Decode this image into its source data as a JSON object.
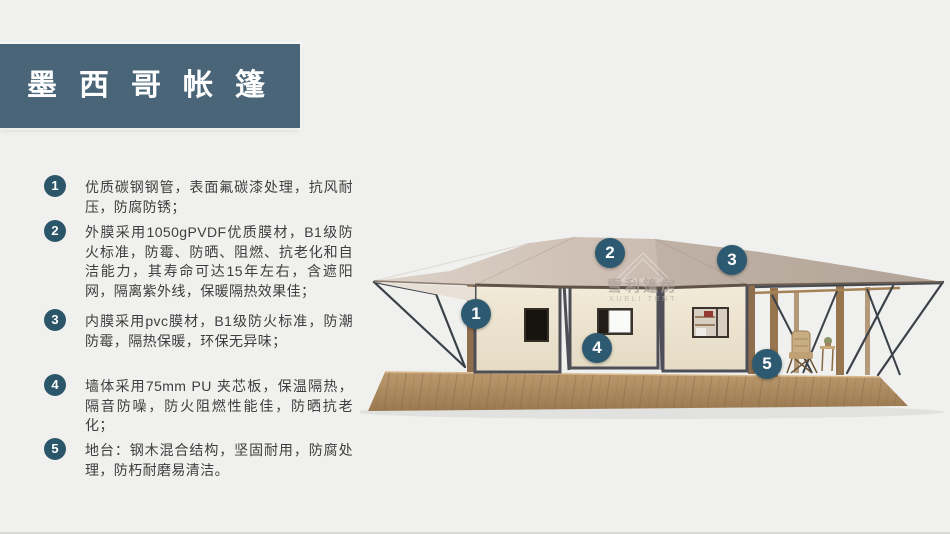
{
  "header": {
    "title": "墨西哥帐篷"
  },
  "features": [
    {
      "num": "1",
      "text": "优质碳钢钢管，表面氟碳漆处理，抗风耐压，防腐防锈；"
    },
    {
      "num": "2",
      "text": "外膜采用1050gPVDF优质膜材，B1级防火标准，防霉、防晒、阻燃、抗老化和自洁能力，其寿命可达15年左右，含遮阳网，隔离紫外线，保暖隔热效果佳；"
    },
    {
      "num": "3",
      "text": "内膜采用pvc膜材，B1级防火标准，防潮防霉，隔热保暖，环保无异味；"
    },
    {
      "num": "4",
      "text": "墙体采用75mm PU 夹芯板，保温隔热，隔音防噪，防火阻燃性能佳，防晒抗老化；"
    },
    {
      "num": "5",
      "text": "地台：钢木混合结构，坚固耐用，防腐处理，防朽耐磨易清洁。"
    }
  ],
  "illustration": {
    "watermark": {
      "cn": "雪利篷房",
      "en": "XUELI TENT"
    },
    "callouts": [
      {
        "num": "1"
      },
      {
        "num": "2"
      },
      {
        "num": "3"
      },
      {
        "num": "4"
      },
      {
        "num": "5"
      }
    ],
    "colors": {
      "title_bar": "#4a6577",
      "badge": "#2b5568",
      "callout": "#2d5a70",
      "roof": "#cbbcb1",
      "wall": "#ece4d2",
      "frame": "#4d4e56",
      "deck": "#ab875d",
      "text": "#3e3e3e",
      "background": "#f0f0ee"
    }
  }
}
